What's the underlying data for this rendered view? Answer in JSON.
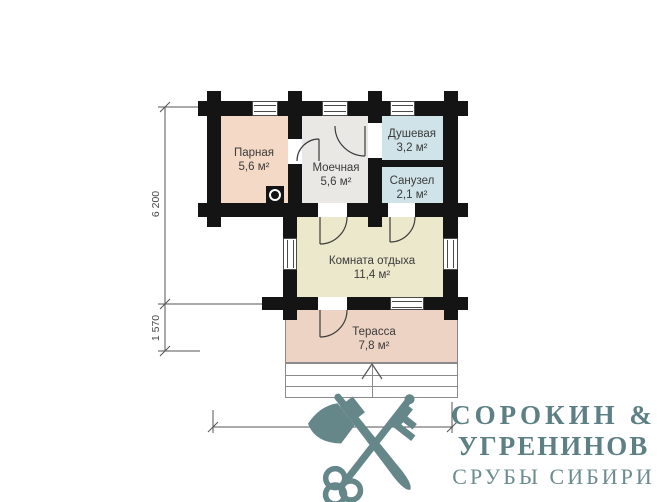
{
  "plan": {
    "wall_color": "#141414",
    "line_color": "#555555",
    "rooms": [
      {
        "id": "parnaya",
        "name": "Парная",
        "area": "5,6 м²",
        "color": "#f3d9c6"
      },
      {
        "id": "moechnaya",
        "name": "Моечная",
        "area": "5,6 м²",
        "color": "#eae8e4"
      },
      {
        "id": "dushevaya",
        "name": "Душевая",
        "area": "3,2 м²",
        "color": "#cfe3e8"
      },
      {
        "id": "sanuzel",
        "name": "Санузел",
        "area": "2,1 м²",
        "color": "#cfe3e8"
      },
      {
        "id": "komnata",
        "name": "Комната отдыха",
        "area": "11,4 м²",
        "color": "#ece8cc"
      },
      {
        "id": "terrassa",
        "name": "Терасса",
        "area": "7,8 м²",
        "color": "#edd3c3"
      }
    ],
    "dimensions": {
      "left_top": "6 200",
      "left_bottom": "1 570",
      "bottom": "7 500"
    },
    "symbols": [
      "stove-icon",
      "entry-arrow-icon",
      "door-swing",
      "window"
    ]
  },
  "logo": {
    "line1": "СОРОКИН &",
    "line2": "УГРЕНИНОВ",
    "line3": "СРУБЫ СИБИРИ",
    "text_color": "#5d8084",
    "subtitle_color": "#6b8c8e",
    "emblem_color": "#66878a",
    "emblem": [
      "axe-icon",
      "key-icon"
    ]
  }
}
